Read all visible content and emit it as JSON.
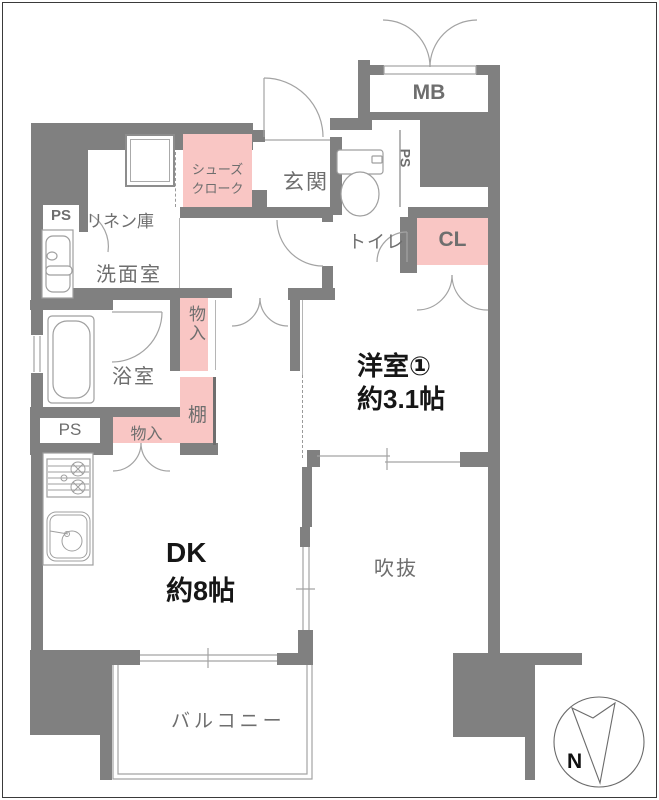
{
  "floorplan": {
    "labels": {
      "ps": "PS",
      "linen": "リネン庫",
      "washroom": "洗面室",
      "shoes1": "シューズ",
      "shoes2": "クローク",
      "entrance": "玄関",
      "toilet": "トイレ",
      "mb": "MB",
      "cl": "CL",
      "bath": "浴室",
      "storage": "物入",
      "shelf": "棚",
      "west_room_name": "洋室①",
      "west_room_size": "約3.1帖",
      "dk_name": "DK",
      "dk_size": "約8帖",
      "void": "吹抜",
      "balcony": "バルコニー",
      "north": "N"
    },
    "colors": {
      "wall": "#808080",
      "closet_pink": "#f9c6c4",
      "room_label": "#6e6e6e",
      "main_text": "#161616",
      "fixture_line": "#9f9f9f"
    }
  }
}
